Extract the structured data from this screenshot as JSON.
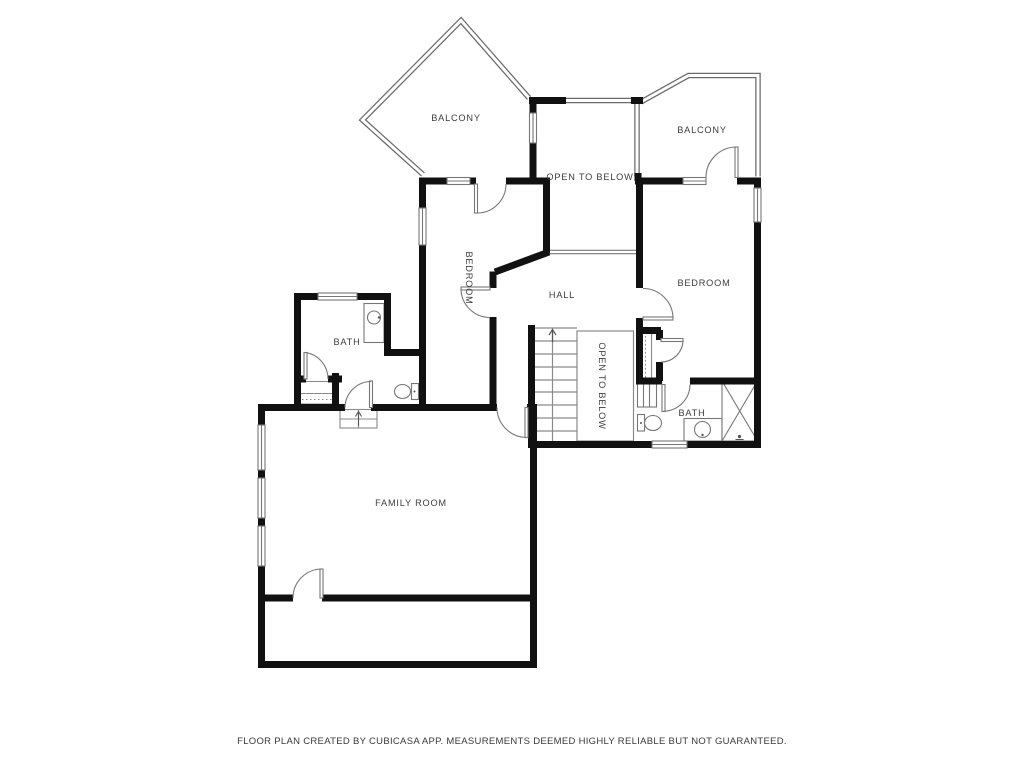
{
  "page": {
    "background": "#ffffff",
    "type": "floor-plan"
  },
  "colors": {
    "wall": "#111111",
    "thin_line": "#777777",
    "railing": "#6a6a6a",
    "label": "#3d3d3d"
  },
  "rooms": [
    {
      "id": "balcony-left",
      "label": "BALCONY"
    },
    {
      "id": "balcony-right",
      "label": "BALCONY"
    },
    {
      "id": "open-to-below-upper",
      "label": "OPEN TO BELOW"
    },
    {
      "id": "bedroom-left",
      "label": "BEDROOM"
    },
    {
      "id": "hall",
      "label": "HALL"
    },
    {
      "id": "bedroom-right",
      "label": "BEDROOM"
    },
    {
      "id": "bath-left",
      "label": "BATH"
    },
    {
      "id": "open-to-below-stairs",
      "label": "OPEN TO BELOW"
    },
    {
      "id": "bath-right",
      "label": "BATH"
    },
    {
      "id": "family-room",
      "label": "FAMILY ROOM"
    },
    {
      "id": "patio-occluded",
      "label": "PATIO",
      "occluded": true
    }
  ],
  "fixtures": [
    "stairs",
    "stairs-up-arrow",
    "entry-steps",
    "entry-steps-arrow",
    "sink-vanity-left",
    "sink-vanity-right",
    "toilet-left",
    "toilet-right",
    "shower",
    "wardrobe-dashed",
    "linen-shelves",
    "closet-rod-dashed",
    "door-swings",
    "windows",
    "balcony-railings"
  ],
  "footer": {
    "disclaimer": "FLOOR PLAN CREATED BY CUBICASA APP. MEASUREMENTS DEEMED HIGHLY RELIABLE BUT NOT GUARANTEED."
  }
}
